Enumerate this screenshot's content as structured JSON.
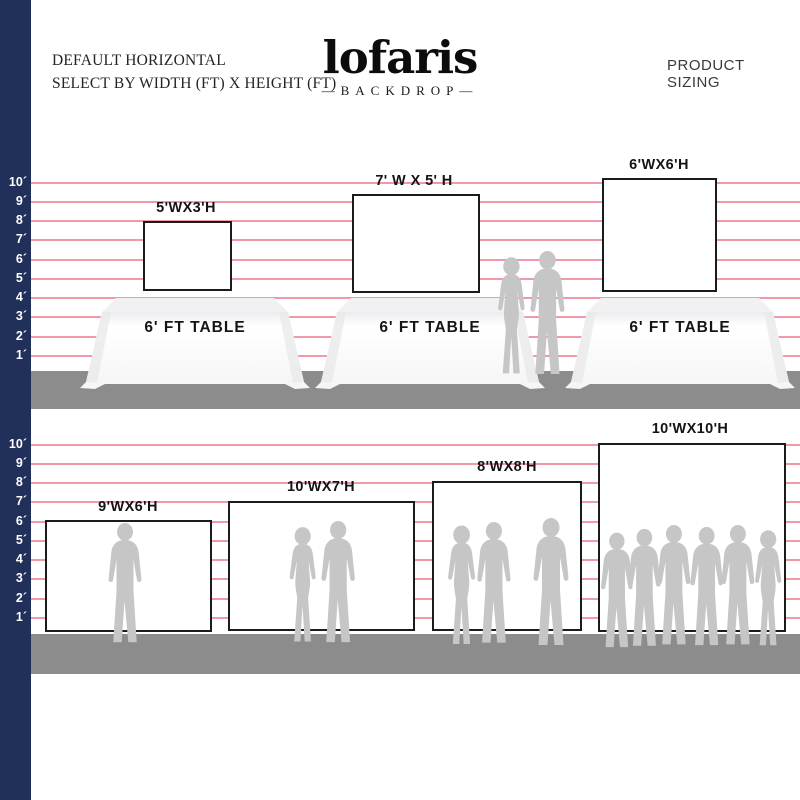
{
  "header": {
    "subtitle_line1": "DEFAULT HORIZONTAL",
    "subtitle_line2": "SELECT BY WIDTH (FT) X HEIGHT (FT)",
    "logo_text": "lofaris",
    "logo_tagline": "—BACKDROP—",
    "right_title": "PRODUCT SIZING"
  },
  "ruler": {
    "labels": [
      "10´",
      "9´",
      "8´",
      "7´",
      "6´",
      "5´",
      "4´",
      "3´",
      "2´",
      "1´"
    ]
  },
  "sections": [
    {
      "backdrops": [
        {
          "label": "5'WX3'H"
        },
        {
          "label": "7' W X 5' H"
        },
        {
          "label": "6'WX6'H"
        }
      ],
      "tables": [
        {
          "label": "6' FT TABLE"
        },
        {
          "label": "6' FT TABLE"
        },
        {
          "label": "6' FT TABLE"
        }
      ]
    },
    {
      "backdrops": [
        {
          "label": "9'WX6'H"
        },
        {
          "label": "10'WX7'H"
        },
        {
          "label": "8'WX8'H"
        },
        {
          "label": "10'WX10'H"
        }
      ]
    }
  ],
  "colors": {
    "navy": "#20305a",
    "line-pink": "#f099a8",
    "floor": "#8c8c8c",
    "silhouette": "#c6c6c6",
    "border-dark": "#1b1b1b"
  }
}
